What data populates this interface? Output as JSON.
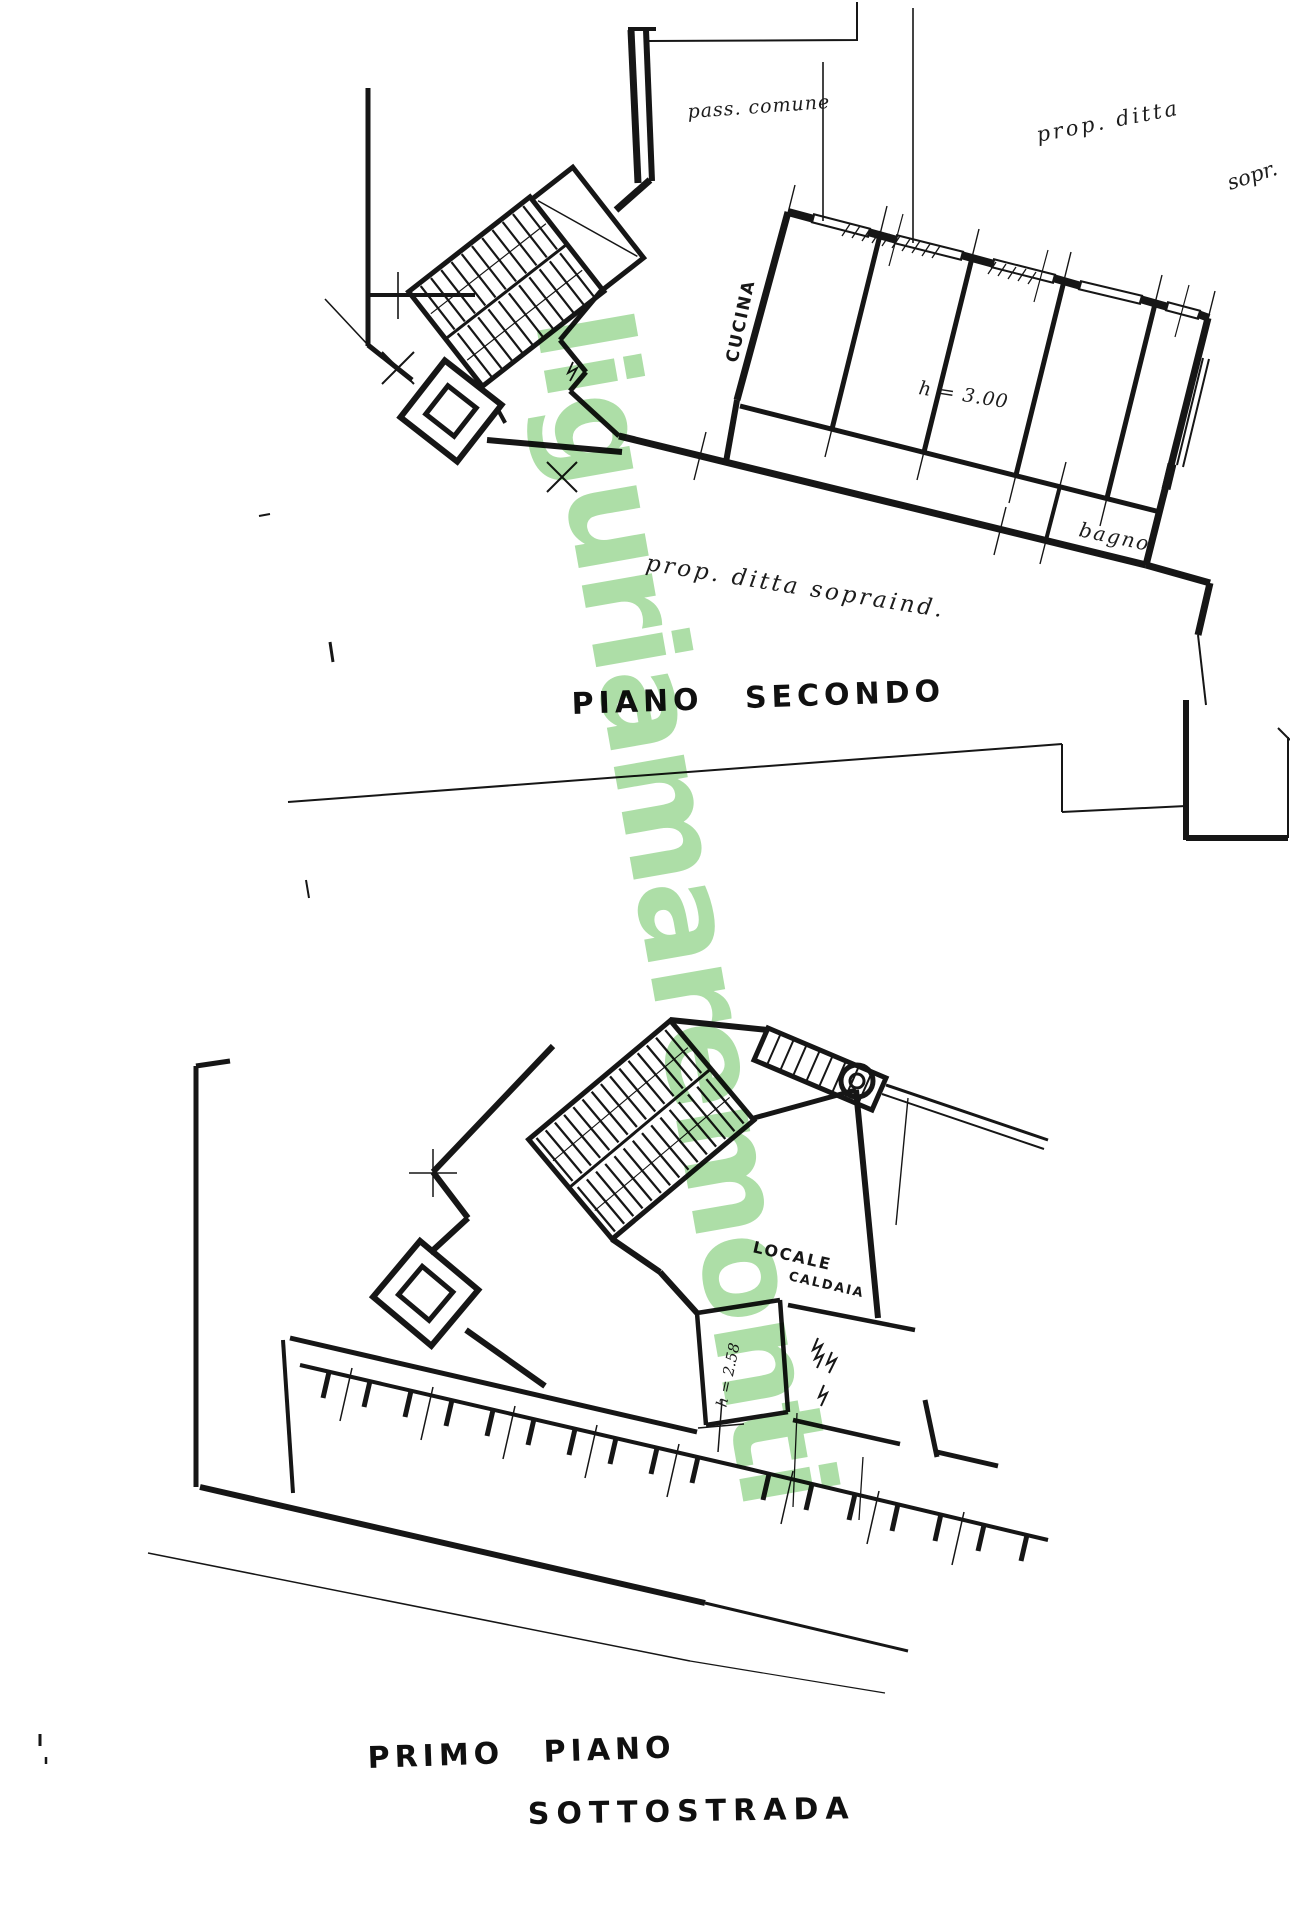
{
  "watermark": {
    "text": "liguriamaremonti",
    "color": "#69c25e"
  },
  "upper_plan": {
    "title": "PIANO SECONDO",
    "labels": {
      "pass_comune": "pass. comune",
      "prop_ditta_top": "prop. ditta",
      "prop_ditta_top_2": "sopr.",
      "cucina": "CUCINA",
      "room_height": "h = 3.00",
      "bagno": "bagno",
      "prop_ditta_bottom": "prop. ditta sopraind."
    }
  },
  "lower_plan": {
    "title_line1": "PRIMO PIANO",
    "title_line2": "SOTTOSTRADA",
    "labels": {
      "locale_caldaia_line1": "LOCALE",
      "locale_caldaia_line2": "CALDAIA",
      "room_height": "h = 2.58"
    }
  }
}
